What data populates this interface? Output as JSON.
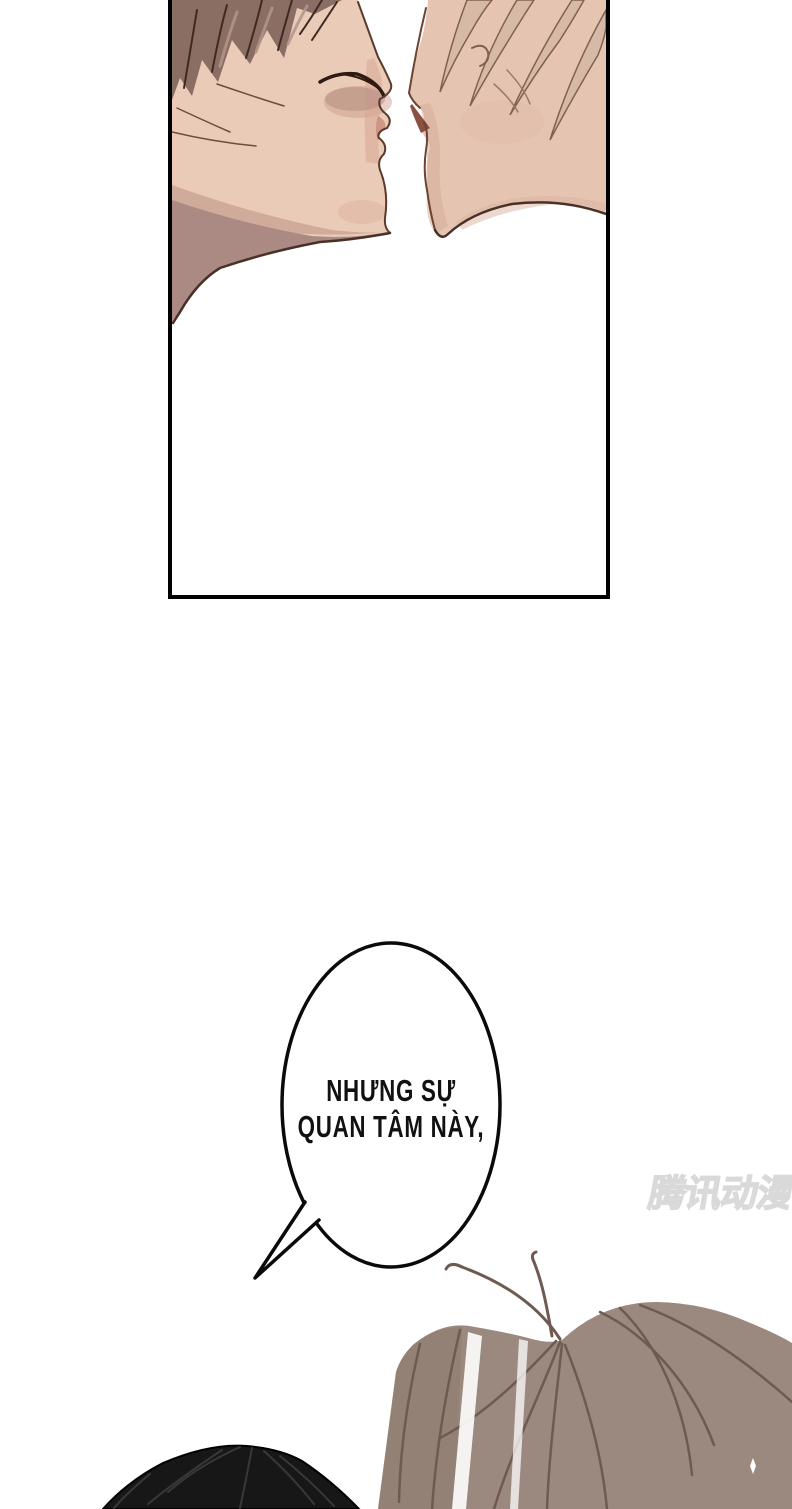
{
  "dialogue": {
    "line1": "NHƯNG SỰ",
    "line2": "QUAN TÂM NÀY,"
  },
  "watermark": {
    "text": "腾讯动漫"
  },
  "palette": {
    "panel_border": "#000000",
    "bubble_stroke": "#0a0a0a",
    "dialogue_color": "#111111",
    "watermark_gray": "#d9d9d9",
    "left_skin": "#e9cbb8",
    "left_skin_shadow": "#c9a192",
    "left_neck_shadow": "#ac8a84",
    "left_hair": "#8a6d63",
    "left_hair_dark": "#3f2a22",
    "left_hair_light": "#b4958a",
    "outline_brown": "#5a3a2c",
    "right_skin": "#e5c5b2",
    "right_skin_shadow": "#d5ab97",
    "right_hair": "#d6b9a7",
    "right_hair_outline": "#82604f",
    "nostril_shadow": "#8a5140",
    "bottom_black_hair": "#171717",
    "bottom_black_line": "#383838",
    "bottom_brown_hair": "#9b897f",
    "bottom_brown_line": "#6e5a50"
  }
}
